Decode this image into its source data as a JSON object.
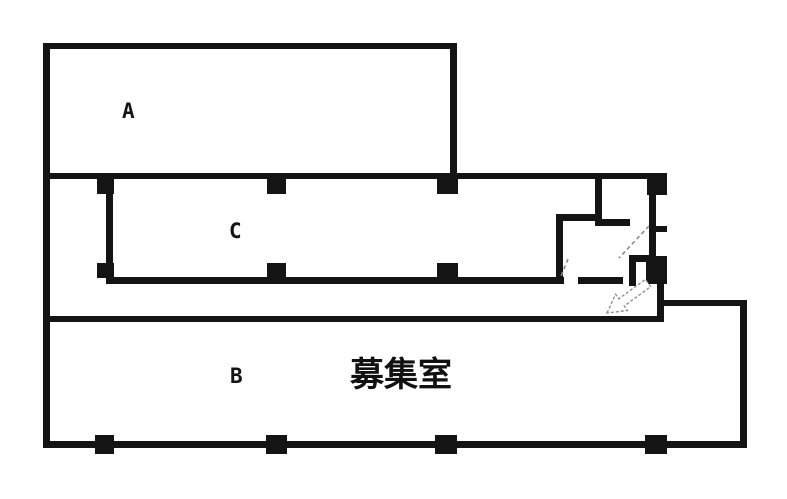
{
  "diagram": {
    "type": "floor-plan",
    "background_color": "#ffffff",
    "wall_color": "#141414",
    "annotation_color": "#8a8a8a",
    "rooms": [
      {
        "id": "A",
        "label": "A"
      },
      {
        "id": "C",
        "label": "C"
      },
      {
        "id": "B",
        "label": "B"
      },
      {
        "id": "recruit",
        "label": "募集室"
      }
    ],
    "annotations": [
      {
        "id": "entry-arrow",
        "meaning": "entry direction arrow pointing down-left"
      },
      {
        "id": "door-swings",
        "meaning": "dashed door swing marks"
      }
    ]
  }
}
